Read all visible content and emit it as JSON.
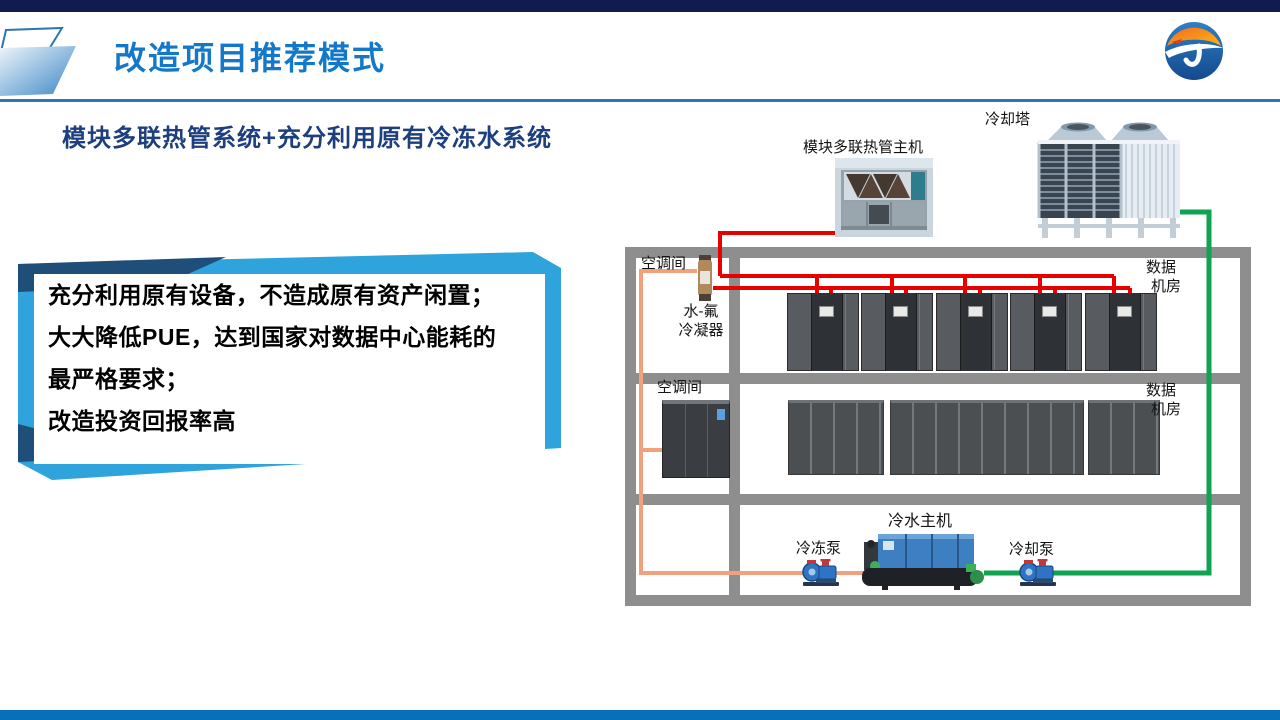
{
  "header": {
    "title": "改造项目推荐模式"
  },
  "logo": {
    "letter": "J"
  },
  "content": {
    "subtitle": "模块多联热管系统+充分利用原有冷冻水系统",
    "highlight_box_lines": [
      "充分利用原有设备，不造成原有资产闲置；",
      "大大降低PUE，达到国家对数据中心能耗的",
      "最严格要求；",
      "改造投资回报率高"
    ]
  },
  "diagram": {
    "labels": {
      "cooling_tower": "冷却塔",
      "module_host": "模块多联热管主机",
      "ac_room_1": "空调间",
      "condenser": [
        "水-氟",
        "冷凝器"
      ],
      "data_room_1": [
        "数据",
        "机房"
      ],
      "ac_room_2": "空调间",
      "data_room_2": [
        "数据",
        "机房"
      ],
      "chiller": "冷水主机",
      "chilled_pump": "冷冻泵",
      "cooling_pump": "冷却泵"
    }
  },
  "colors": {
    "title_blue": "#1478ca",
    "subtitle_navy": "#1e3f7d",
    "accent_light_blue": "#2ea3dc",
    "accent_navy": "#1f4e79",
    "pipe_red": "#e60000",
    "pipe_orange": "#f2a17e",
    "pipe_green": "#0fa352",
    "wall_gray": "#8e8e8e",
    "top_bar_navy": "#121b4f",
    "footer_blue": "#0a6fba"
  }
}
